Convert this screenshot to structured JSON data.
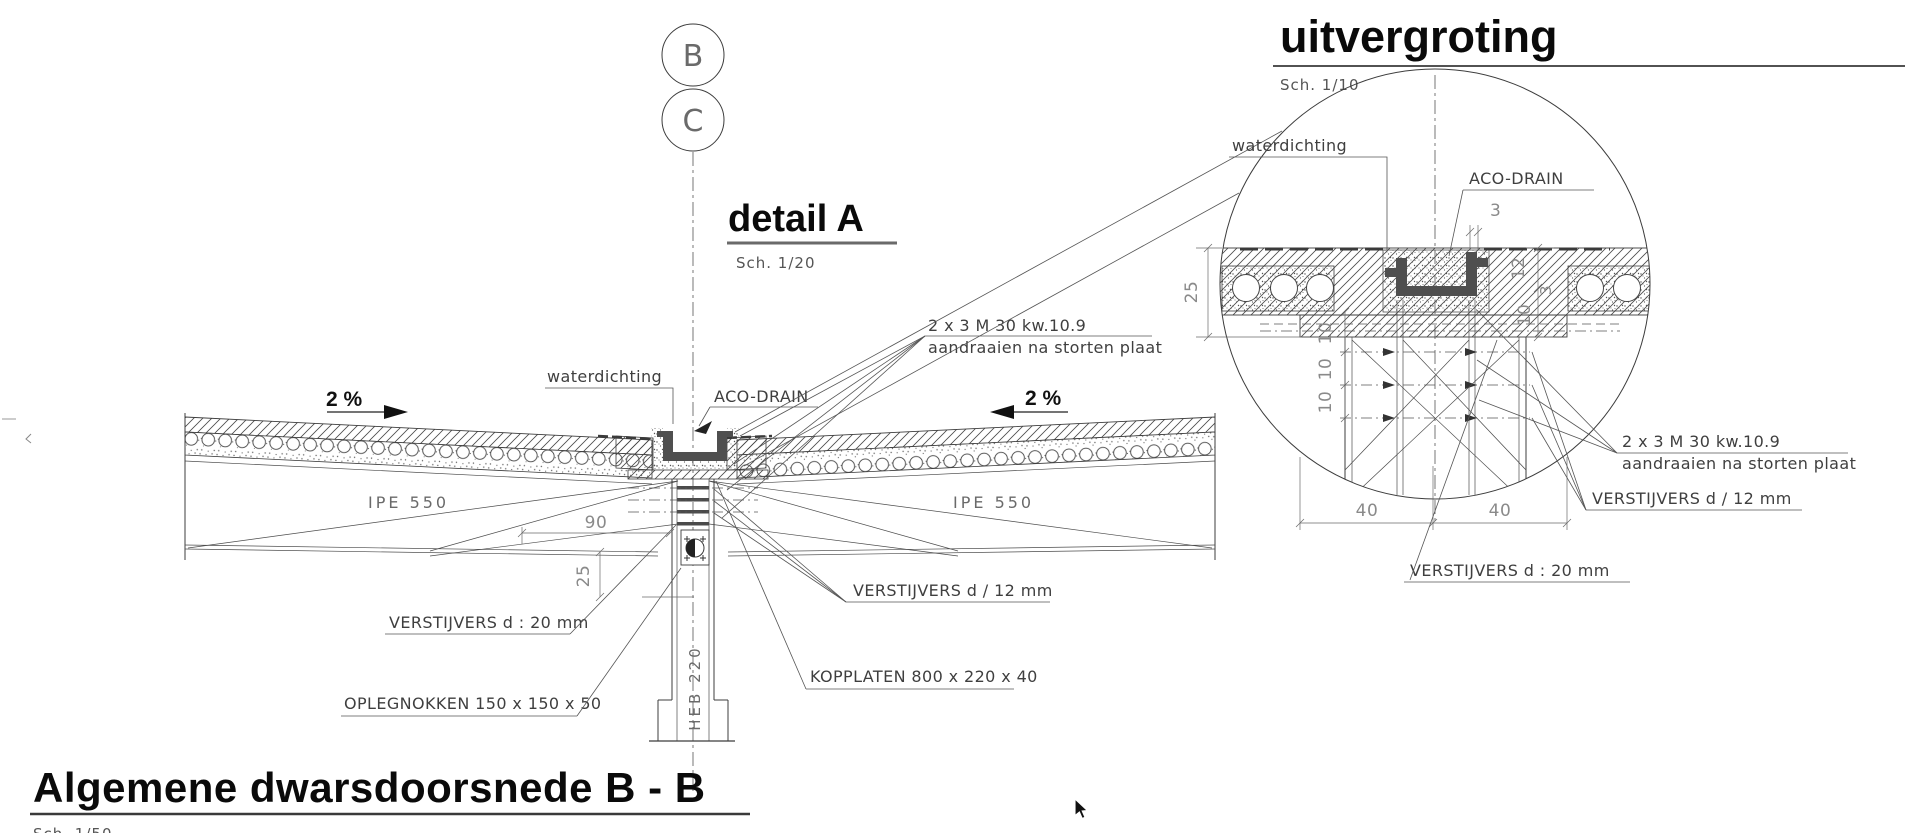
{
  "markers": {
    "b": "B",
    "c": "C"
  },
  "detail_a": {
    "title": "detail A",
    "scale": "Sch. 1/20",
    "slope_left": "2 %",
    "slope_right": "2 %",
    "beam_left": "IPE 550",
    "beam_right": "IPE 550",
    "column": "HEB 220",
    "label_waterproofing": "waterdichting",
    "label_drain": "ACO-DRAIN",
    "label_bolts1": "2 x 3 M 30 kw.10.9",
    "label_bolts2": "aandraaien na storten plaat",
    "label_stiff12": "VERSTIJVERS d / 12 mm",
    "label_stiff20": "VERSTIJVERS d : 20 mm",
    "label_kopplaten": "KOPPLATEN 800 x 220 x 40",
    "label_oplegnokken": "OPLEGNOKKEN 150 x 150 x 50",
    "dim_90": "90",
    "dim_25": "25"
  },
  "enlargement": {
    "title": "uitvergroting",
    "scale": "Sch. 1/10",
    "label_waterproofing": "waterdichting",
    "label_drain": "ACO-DRAIN",
    "label_bolts1": "2 x 3 M 30 kw.10.9",
    "label_bolts2": "aandraaien na storten plaat",
    "label_stiff12": "VERSTIJVERS d / 12 mm",
    "label_stiff20": "VERSTIJVERS d : 20 mm",
    "dim_3_top": "3",
    "dim_25": "25",
    "dim_12": "12",
    "dim_3_side": "3",
    "dim_10_side": "10",
    "dim_10_1": "10",
    "dim_10_2": "10",
    "dim_10_3": "10",
    "dim_40_left": "40",
    "dim_40_right": "40"
  },
  "section_title": {
    "title": "Algemene dwarsdoorsnede B - B",
    "scale": "Sch. 1/50"
  },
  "colors": {
    "line": "#3c3c3c",
    "channel": "#4f4f4f",
    "title": "#0a0a0a",
    "dim_text": "#8a8a8a"
  }
}
